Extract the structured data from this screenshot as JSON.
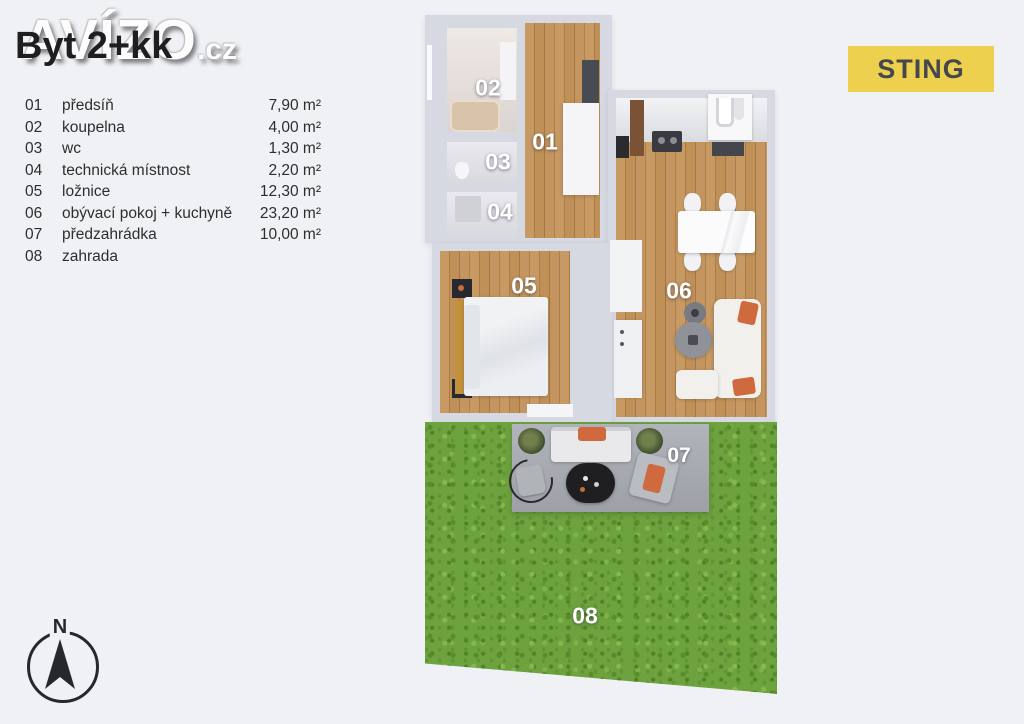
{
  "header": {
    "title": "Byt 2+kk",
    "watermark_main": "AVÍZO",
    "watermark_suffix": ".cz"
  },
  "brand": {
    "label": "STING",
    "background": "#edd14e",
    "text_color": "#46474c"
  },
  "legend": {
    "rows": [
      {
        "num": "01",
        "name": "předsíň",
        "area": "7,90 m²"
      },
      {
        "num": "02",
        "name": "koupelna",
        "area": "4,00 m²"
      },
      {
        "num": "03",
        "name": "wc",
        "area": "1,30 m²"
      },
      {
        "num": "04",
        "name": "technická místnost",
        "area": "2,20 m²"
      },
      {
        "num": "05",
        "name": "ložnice",
        "area": "12,30 m²"
      },
      {
        "num": "06",
        "name": "obývací pokoj + kuchyně",
        "area": "23,20 m²"
      },
      {
        "num": "07",
        "name": "předzahrádka",
        "area": "10,00 m²"
      },
      {
        "num": "08",
        "name": "zahrada",
        "area": ""
      }
    ]
  },
  "floorplan": {
    "labels": {
      "r01": "01",
      "r02": "02",
      "r03": "03",
      "r04": "04",
      "r05": "05",
      "r06": "06",
      "r07": "07",
      "r08": "08"
    },
    "colors": {
      "wall": "#d7d9e2",
      "wood_floor": "#bd8d55",
      "grass": "#6da23f",
      "terrace": "#a4a8ad",
      "accent_cushion": "#ce6a3e"
    }
  },
  "compass": {
    "north_label": "N"
  }
}
